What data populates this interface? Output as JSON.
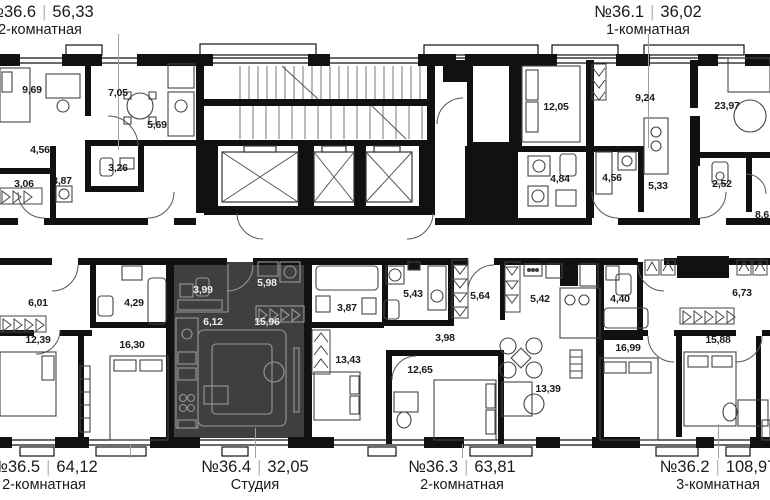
{
  "plan": {
    "wall_color": "#111111",
    "highlight_color": "#3f3f3f",
    "highlighted_apartment": "№36.4"
  },
  "apartments": {
    "apt36_6": {
      "number": "№36.6",
      "area": "56,33",
      "type": "2-комнатная"
    },
    "apt36_1": {
      "number": "№36.1",
      "area": "36,02",
      "type": "1-комнатная"
    },
    "apt36_5": {
      "number": "№36.5",
      "area": "64,12",
      "type": "2-комнатная"
    },
    "apt36_4": {
      "number": "№36.4",
      "area": "32,05",
      "type": "Студия"
    },
    "apt36_3": {
      "number": "№36.3",
      "area": "63,81",
      "type": "2-комнатная"
    },
    "apt36_2": {
      "number": "№36.2",
      "area": "108,97",
      "type": "3-комнатная"
    }
  },
  "rooms": [
    {
      "area": "9,69"
    },
    {
      "area": "7,05"
    },
    {
      "area": "5,69"
    },
    {
      "area": "4,56"
    },
    {
      "area": "3,26"
    },
    {
      "area": "3,87"
    },
    {
      "area": "3,06"
    },
    {
      "area": "12,05"
    },
    {
      "area": "9,24"
    },
    {
      "area": "23,97"
    },
    {
      "area": "5,33"
    },
    {
      "area": "4,56"
    },
    {
      "area": "4,84"
    },
    {
      "area": "2,52"
    },
    {
      "area": "8,6"
    },
    {
      "area": "6,01"
    },
    {
      "area": "4,29"
    },
    {
      "area": "12,39"
    },
    {
      "area": "16,30"
    },
    {
      "area": "3,99"
    },
    {
      "area": "5,98"
    },
    {
      "area": "6,12"
    },
    {
      "area": "15,96"
    },
    {
      "area": "3,87"
    },
    {
      "area": "13,43"
    },
    {
      "area": "5,43"
    },
    {
      "area": "5,64"
    },
    {
      "area": "5,42"
    },
    {
      "area": "3,98"
    },
    {
      "area": "12,65"
    },
    {
      "area": "13,39"
    },
    {
      "area": "4,40"
    },
    {
      "area": "6,73"
    },
    {
      "area": "16,99"
    },
    {
      "area": "15,88"
    }
  ]
}
